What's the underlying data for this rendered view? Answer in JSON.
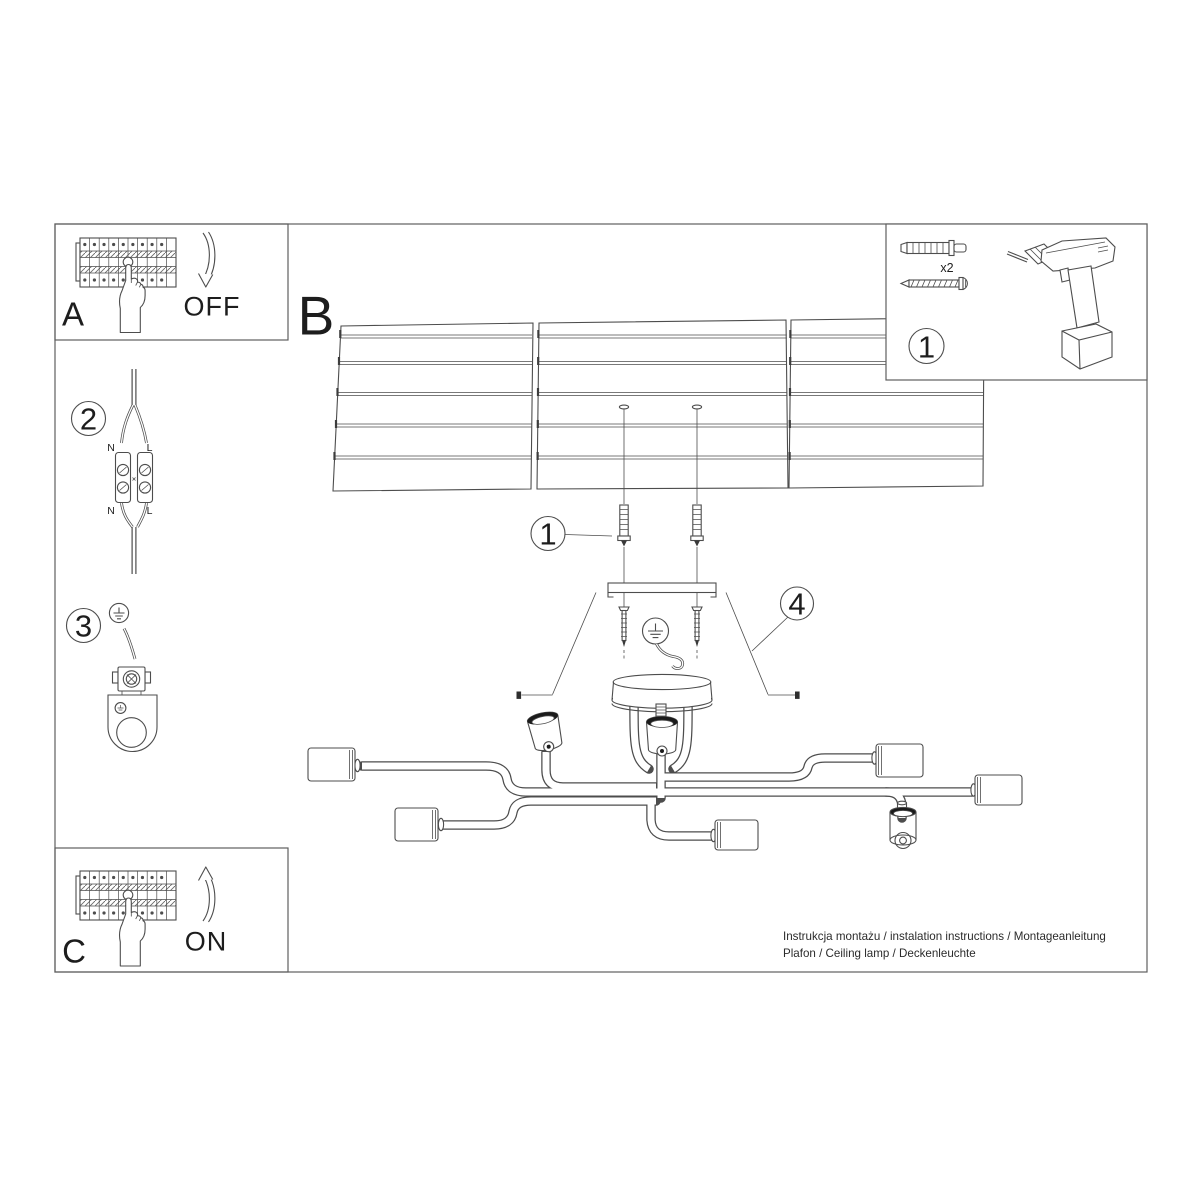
{
  "page": {
    "background": "#ffffff",
    "line_color": "#4d4d4d",
    "text_color": "#1d1d1d"
  },
  "panel_a": {
    "label": "A",
    "state": "OFF"
  },
  "panel_c": {
    "label": "C",
    "state": "ON"
  },
  "main_step": {
    "label": "B"
  },
  "step1": {
    "number": "1"
  },
  "step2": {
    "number": "2",
    "wire_top_left": "N",
    "wire_top_right": "L",
    "wire_bottom_left": "N",
    "wire_bottom_right": "L"
  },
  "step3": {
    "number": "3"
  },
  "step4": {
    "number": "4"
  },
  "parts_box": {
    "number": "1",
    "anchor_qty": "x2"
  },
  "footer": {
    "line1": "Instrukcja montażu / instalation instructions / Montageanleitung",
    "line2": "Plafon / Ceiling lamp / Deckenleuchte"
  }
}
